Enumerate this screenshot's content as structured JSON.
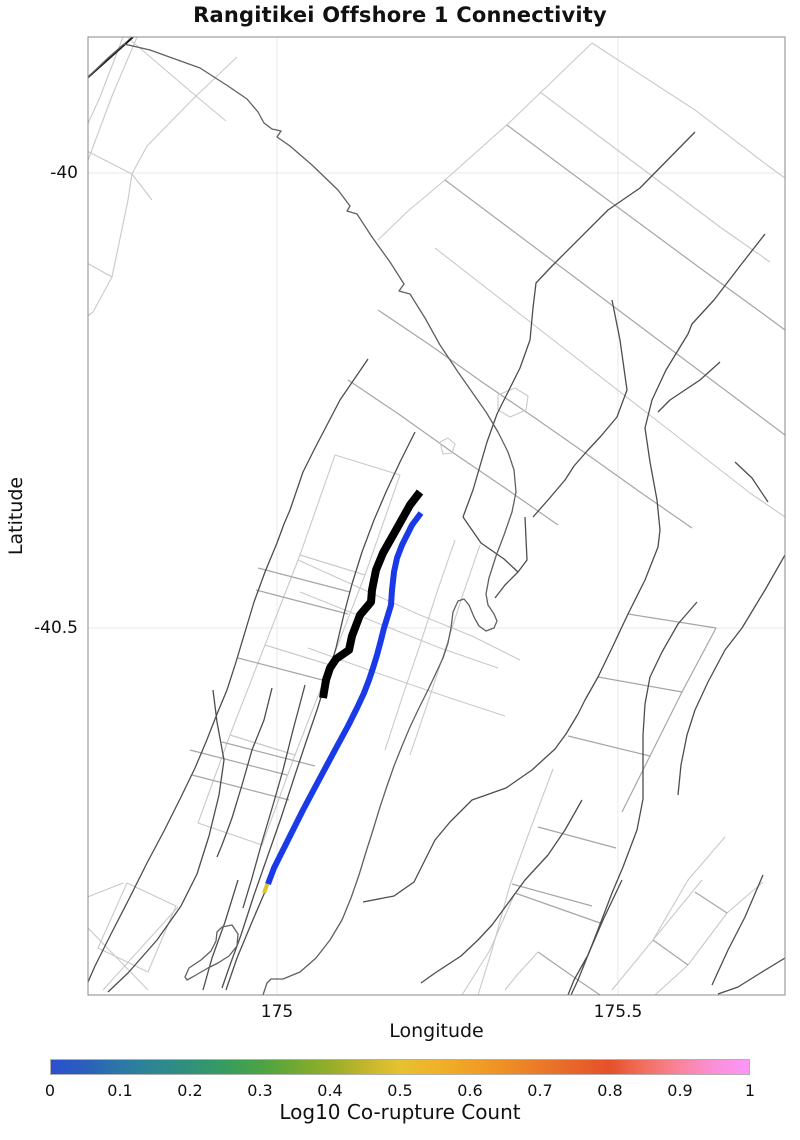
{
  "title": "Rangitikei Offshore 1 Connectivity",
  "axes": {
    "xlabel": "Longitude",
    "ylabel": "Latitude",
    "xticks": [
      {
        "label": "175",
        "px": 277
      },
      {
        "label": "175.5",
        "px": 618
      }
    ],
    "yticks": [
      {
        "label": "-40",
        "px": 173
      },
      {
        "label": "-40.5",
        "px": 628
      }
    ]
  },
  "colorbar": {
    "label": "Log10 Co-rupture Count",
    "left_px": 50,
    "top_px": 1059,
    "width_px": 700,
    "height_px": 16,
    "ticks": [
      {
        "label": "0",
        "px": 50
      },
      {
        "label": "0.1",
        "px": 120
      },
      {
        "label": "0.2",
        "px": 190
      },
      {
        "label": "0.3",
        "px": 260
      },
      {
        "label": "0.4",
        "px": 330
      },
      {
        "label": "0.5",
        "px": 400
      },
      {
        "label": "0.6",
        "px": 470
      },
      {
        "label": "0.7",
        "px": 540
      },
      {
        "label": "0.8",
        "px": 610
      },
      {
        "label": "0.9",
        "px": 680
      },
      {
        "label": "1",
        "px": 750
      }
    ],
    "stops": [
      [
        0,
        "#2b4fd0"
      ],
      [
        0.05,
        "#2a60bb"
      ],
      [
        0.1,
        "#2b78a6"
      ],
      [
        0.15,
        "#2d8792"
      ],
      [
        0.2,
        "#2f927b"
      ],
      [
        0.25,
        "#379c5f"
      ],
      [
        0.3,
        "#4aa344"
      ],
      [
        0.35,
        "#70a932"
      ],
      [
        0.4,
        "#95ad29"
      ],
      [
        0.45,
        "#c2b62c"
      ],
      [
        0.5,
        "#e6c230"
      ],
      [
        0.55,
        "#f0b228"
      ],
      [
        0.6,
        "#f0a124"
      ],
      [
        0.65,
        "#ee8f26"
      ],
      [
        0.7,
        "#ea7a28"
      ],
      [
        0.75,
        "#e86529"
      ],
      [
        0.8,
        "#e5512a"
      ],
      [
        0.85,
        "#f2705e"
      ],
      [
        0.9,
        "#f9849b"
      ],
      [
        0.95,
        "#fb8fd9"
      ],
      [
        1,
        "#fd97f6"
      ]
    ]
  },
  "chart_data": {
    "type": "line",
    "title": "Rangitikei Offshore 1 Connectivity",
    "xlabel": "Longitude",
    "ylabel": "Latitude",
    "xlim": [
      174.72,
      175.75
    ],
    "ylim": [
      -40.9,
      -39.85
    ],
    "xticks": [
      175,
      175.5
    ],
    "yticks": [
      -40,
      -40.5
    ],
    "grid": true,
    "legend": "colorbar bottom, Log10 Co-rupture Count 0 to 1",
    "plot_rect_px": {
      "x": 88,
      "y": 37,
      "w": 697,
      "h": 958
    },
    "highlighted_series": [
      {
        "name": "Rangitikei Offshore 1 source fault",
        "color": "#000000",
        "approx_lonlat": [
          [
            175.21,
            -40.35
          ],
          [
            175.067,
            -40.576
          ]
        ]
      },
      {
        "name": "co-rupture fault (log10 count ~0)",
        "color": "#1a3ae8",
        "approx_lonlat": [
          [
            175.211,
            -40.373
          ],
          [
            174.987,
            -40.78
          ]
        ]
      },
      {
        "name": "co-rupture fault segment (log10 count ~0.5)",
        "color": "#d9c42f",
        "approx_lonlat": [
          [
            174.987,
            -40.78
          ],
          [
            174.981,
            -40.79
          ]
        ]
      }
    ],
    "styles": {
      "grid": {
        "stroke": "#e8e8e8",
        "w": 1,
        "cap": "butt"
      },
      "light": {
        "stroke": "#c9c9c9",
        "w": 1.1,
        "cap": "butt"
      },
      "mid": {
        "stroke": "#a6a6a6",
        "w": 1.2,
        "cap": "butt"
      },
      "dark": {
        "stroke": "#4d4d4d",
        "w": 1.3,
        "cap": "butt"
      },
      "darker": {
        "stroke": "#1a1a1a",
        "w": 2,
        "cap": "butt"
      },
      "coast": {
        "stroke": "#606060",
        "w": 1.3,
        "cap": "butt"
      },
      "black": {
        "stroke": "#000000",
        "w": 8,
        "cap": "butt"
      },
      "blue": {
        "stroke": "#1a3ae8",
        "w": 6,
        "cap": "butt"
      },
      "yellow": {
        "stroke": "#d9c42f",
        "w": 4,
        "cap": "butt"
      }
    },
    "traces": [
      {
        "c": "grid",
        "n": "gridline-lon-175",
        "p": "277,37 277,995"
      },
      {
        "c": "grid",
        "n": "gridline-lon-175-5",
        "p": "618,37 618,995"
      },
      {
        "c": "grid",
        "n": "gridline-lat-40",
        "p": "88,173 785,173"
      },
      {
        "c": "grid",
        "n": "gridline-lat-40-5",
        "p": "88,628 785,628"
      },
      {
        "c": "light",
        "p": "123,37 100,97 85,130"
      },
      {
        "c": "light",
        "p": "137,37 112,96 90,155 85,168"
      },
      {
        "c": "light",
        "p": "237,57 195,97 147,146 132,174 128,200 112,277 93,312 85,318"
      },
      {
        "c": "light",
        "p": "85,262 112,277"
      },
      {
        "c": "light",
        "p": "85,150 132,174 152,200"
      },
      {
        "c": "light",
        "p": "128,38 196,96 226,121"
      },
      {
        "c": "light",
        "p": "592,43 510,122 445,180 408,211 378,240"
      },
      {
        "c": "light",
        "p": "592,43 695,110 767,165 785,178"
      },
      {
        "c": "mid",
        "p": "445,180 505,225 565,270 625,315 685,360 745,405 785,435"
      },
      {
        "c": "mid",
        "p": "507,125 570,172 635,220 700,268 762,313 785,330"
      },
      {
        "c": "light",
        "p": "540,92 600,137 660,182 720,227 770,262"
      },
      {
        "c": "light",
        "p": "435,248 480,283 525,318 570,353 615,388 660,423 705,458 750,493 785,517"
      },
      {
        "c": "light",
        "p": "335,455 400,475 365,575 300,555 335,455"
      },
      {
        "c": "light",
        "p": "300,555 365,575 330,665 265,645 300,555"
      },
      {
        "c": "light",
        "p": "265,645 330,665 295,755 230,735 265,645"
      },
      {
        "c": "light",
        "p": "230,735 295,755 262,845 198,823 230,735"
      },
      {
        "c": "mid",
        "p": "190,750 287,775"
      },
      {
        "c": "mid",
        "p": "192,775 289,800"
      },
      {
        "c": "mid",
        "p": "258,568 350,592"
      },
      {
        "c": "mid",
        "p": "256,590 348,614"
      },
      {
        "c": "mid",
        "p": "238,658 330,682"
      },
      {
        "c": "mid",
        "p": "222,742 315,766"
      },
      {
        "c": "light",
        "p": "298,560 360,588 420,615 472,636 520,660"
      },
      {
        "c": "light",
        "p": "300,592 370,620 440,648 498,668"
      },
      {
        "c": "light",
        "p": "308,648 380,674 450,698 505,716"
      },
      {
        "c": "mid",
        "p": "378,310 430,345 482,382 535,418 588,455 640,492 692,528"
      },
      {
        "c": "mid",
        "p": "348,380 400,415 452,452 505,488 558,525"
      },
      {
        "c": "light",
        "p": "455,540 437,592 420,645 402,698 385,750"
      },
      {
        "c": "light",
        "p": "480,545 462,597 445,650 428,702 410,755"
      },
      {
        "c": "mid",
        "p": "628,614 716,628"
      },
      {
        "c": "mid",
        "p": "598,677 682,692"
      },
      {
        "c": "mid",
        "p": "568,736 650,756"
      },
      {
        "c": "mid",
        "p": "716,628 682,692 650,756 622,812"
      },
      {
        "c": "light",
        "p": "553,769 530,830 510,885 492,950 478,995"
      },
      {
        "c": "mid",
        "p": "538,827 616,848"
      },
      {
        "c": "mid",
        "p": "512,884 592,906"
      },
      {
        "c": "light",
        "p": "127,883 176,906 148,972 98,948 127,883"
      },
      {
        "c": "light",
        "p": "85,898 123,883"
      },
      {
        "c": "light",
        "p": "85,925 148,990"
      },
      {
        "c": "light",
        "p": "103,990 178,907"
      },
      {
        "c": "mid",
        "p": "515,893 600,923"
      },
      {
        "c": "light",
        "p": "515,893 490,950 462,995"
      },
      {
        "c": "mid",
        "p": "538,952 578,980 600,995"
      },
      {
        "c": "light",
        "p": "538,952 518,974 505,990"
      },
      {
        "c": "light",
        "p": "702,880 653,940 612,990"
      },
      {
        "c": "light",
        "p": "763,882 727,913 688,965 655,995"
      },
      {
        "c": "mid",
        "p": "695,892 727,913"
      },
      {
        "c": "mid",
        "p": "653,940 688,965"
      },
      {
        "c": "light",
        "p": "725,837 688,880 653,940"
      },
      {
        "c": "light",
        "p": "440,442 448,438 455,444 452,453 443,454 440,442"
      },
      {
        "c": "light",
        "p": "498,395 515,388 528,396 526,410 510,417 498,410 498,395"
      },
      {
        "c": "darker",
        "n": "fault-trace",
        "p": "133,37 85,80"
      },
      {
        "c": "dark",
        "p": "368,359 340,400 315,448 303,472 290,510 284,524 277,543 265,572 254,602 245,632 236,662 227,690 217,714 206,742 195,768 181,797 164,831 147,863 129,899 111,934 95,966 88,982"
      },
      {
        "c": "dark",
        "p": "415,432 400,462 386,492 374,520 362,552 352,584 344,614 336,648 327,678 317,710 306,742 295,775 281,818 267,858 254,895 241,935 230,965 222,988"
      },
      {
        "c": "dark",
        "p": "272,688 264,720 252,750 242,785 232,818 222,845 217,857"
      },
      {
        "c": "dark",
        "p": "213,690 217,722 224,760 219,795 209,836 197,874 181,906 157,940 128,973 108,992"
      },
      {
        "c": "dark",
        "p": "270,880 252,922 237,958 226,990"
      },
      {
        "c": "dark",
        "p": "238,880 225,922 212,958 203,990"
      },
      {
        "c": "dark",
        "p": "305,685 293,730 283,770 273,805 262,842 252,878 243,908"
      },
      {
        "c": "dark",
        "p": "695,132 640,188 608,210 552,266 536,283 533,308 530,340 520,368 508,392 497,414 487,442 473,490 463,517"
      },
      {
        "c": "dark",
        "p": "765,234 740,266 714,300 692,324 688,334 666,370 652,400 645,428 650,462 657,500 660,530 658,547 645,580 628,614 612,648 598,677 585,700 578,714 566,734 555,749 532,770 506,788 472,800 450,822 435,840 414,882 394,896 363,902"
      },
      {
        "c": "dark",
        "p": "720,362 700,380 688,388 670,400 658,412"
      },
      {
        "c": "dark",
        "p": "697,602 678,624 662,652 650,677 645,704 643,735 643,770 643,799 637,830 623,867 612,893 604,914 592,945 578,980 571,995"
      },
      {
        "c": "dark",
        "p": "785,555 765,590 742,628 725,650 708,682 695,710 687,735 681,765 678,795"
      },
      {
        "c": "dark",
        "p": "763,875 745,917 728,950 712,985"
      },
      {
        "c": "dark",
        "p": "785,958 762,972 738,987 718,994"
      },
      {
        "c": "dark",
        "p": "582,800 565,830 548,855 525,880 506,906 492,925 478,940 461,956 435,973 421,983"
      },
      {
        "c": "dark",
        "p": "622,880 603,920 588,955 574,980 568,995"
      },
      {
        "c": "dark",
        "p": "735,462 752,478 768,502"
      },
      {
        "c": "dark",
        "p": "525,517 527,560 518,572 505,585 495,598"
      },
      {
        "c": "dark",
        "p": "463,517 481,543 504,559 518,572"
      },
      {
        "c": "dark",
        "p": "612,300 620,340 627,390 617,417 601,436 588,450 574,466 565,480 548,500 533,517"
      },
      {
        "c": "coast",
        "n": "coastline",
        "p": "85,80 108,58 124,44 150,50 200,68 228,86 247,99 258,112 264,123 272,129 281,131 277,137 290,146 312,165 338,190 350,206 347,211 357,214 372,237 390,262 404,284 399,291 410,294 425,318 440,345 458,372 472,392 486,412 498,432 508,452 514,470 516,492 512,512 504,535 496,556 489,578 486,594 488,605 494,614 497,621 494,628 486,631 479,626 474,617 469,605 464,599 458,601 453,612 451,628 448,643 443,658 436,673 428,690 419,708 410,727 402,746 394,766 387,786 380,807 373,830 366,852 359,875 351,898 342,920 330,940 316,958 300,972 283,979 271,979 267,983 263,995"
      },
      {
        "c": "coast",
        "n": "island-outline",
        "p": "222,927 232,925 238,934 237,946 229,956 218,963 208,968 196,975 187,980 185,977 189,968 201,960 211,951 216,941 217,932 222,927"
      },
      {
        "c": "yellow",
        "n": "corupture-fault-yellow",
        "p": "268,882 264,893"
      },
      {
        "c": "blue",
        "n": "corupture-fault-blue",
        "p": "421,513 412,525 402,545 397,558 394,572 392,590 391,605 388,615 384,628 381,640 377,655 373,668 369,680 364,693 357,708 348,726 335,750 320,778 303,810 287,842 274,868 268,884"
      },
      {
        "c": "black",
        "n": "source-fault-black",
        "p": "420,492 410,505 396,530 383,553 376,570 372,590 371,602 360,615 352,636 349,650 336,659 330,668 326,680 323,698"
      }
    ]
  }
}
